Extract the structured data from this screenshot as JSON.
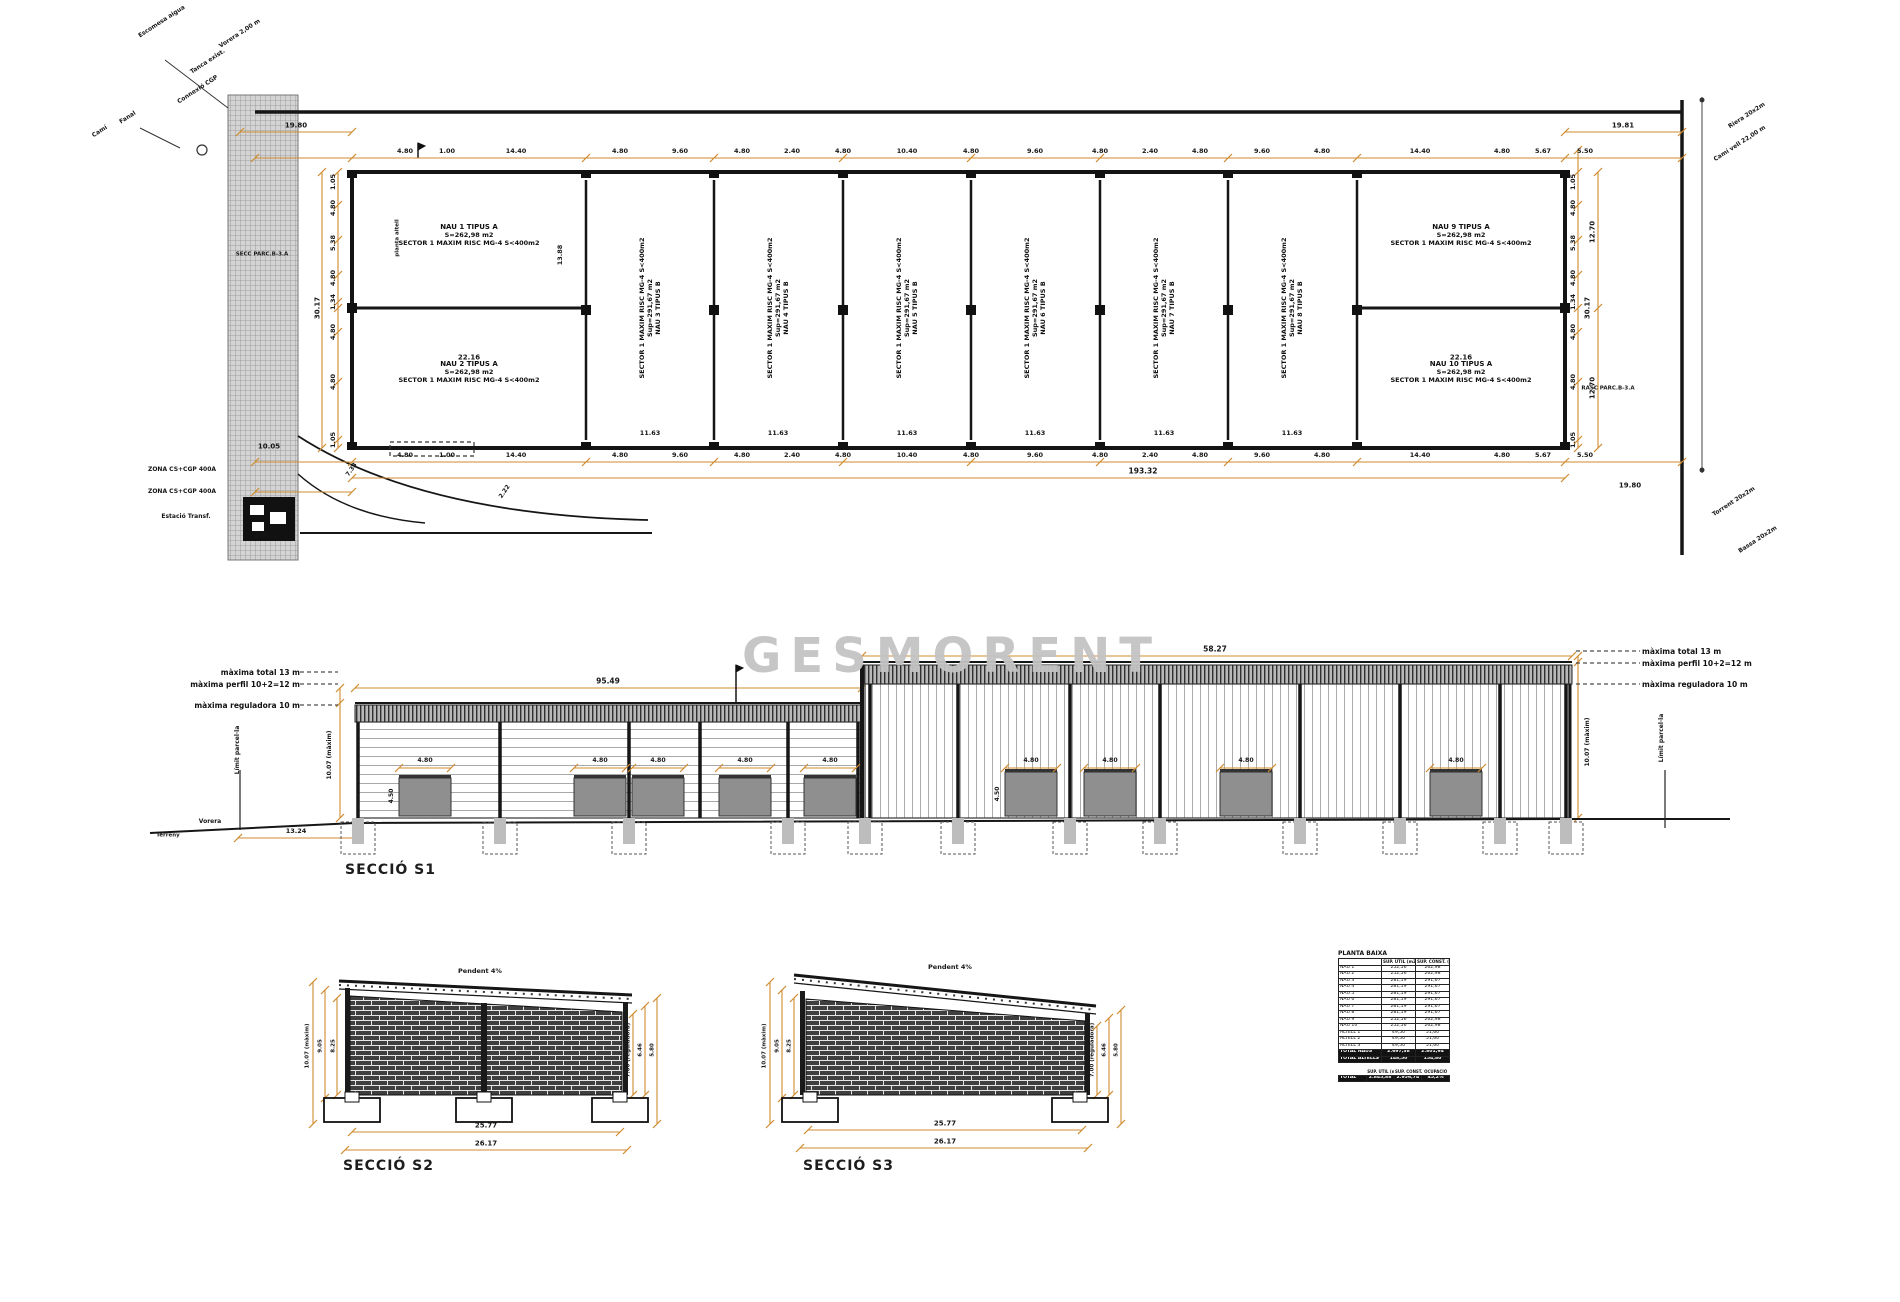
{
  "watermark": "GESMORENT",
  "colors": {
    "dim": "#cf8b2f",
    "wall": "#161616",
    "watermark": "#c3c3c3",
    "door": "#8f8f8f"
  },
  "plan": {
    "dim_row": [
      [
        "4.80",
        405
      ],
      [
        "1.00",
        447
      ],
      [
        "14.40",
        516
      ],
      [
        "4.80",
        620
      ],
      [
        "9.60",
        680
      ],
      [
        "4.80",
        742
      ],
      [
        "2.40",
        792
      ],
      [
        "4.80",
        843
      ],
      [
        "10.40",
        907
      ],
      [
        "4.80",
        971
      ],
      [
        "9.60",
        1035
      ],
      [
        "4.80",
        1100
      ],
      [
        "2.40",
        1150
      ],
      [
        "4.80",
        1200
      ],
      [
        "9.60",
        1262
      ],
      [
        "4.80",
        1322
      ],
      [
        "14.40",
        1420
      ],
      [
        "4.80",
        1502
      ],
      [
        "5.67",
        1543
      ],
      [
        "5.50",
        1585
      ]
    ],
    "left_chain": [
      [
        "1.05",
        182
      ],
      [
        "4.80",
        208
      ],
      [
        "5.38",
        243
      ],
      [
        "4.80",
        278
      ],
      [
        "1.34",
        302
      ],
      [
        "4.80",
        332
      ],
      [
        "4.80",
        382
      ],
      [
        "1.05",
        440
      ]
    ],
    "bays": [
      {
        "l1": "SECTOR 1 MAXIM RISC MG-4 S<400m2",
        "l2": "Sup=291,67 m2",
        "l3": "NAU 3 TIPUS B",
        "x": 650
      },
      {
        "l1": "SECTOR 1 MAXIM RISC MG-4 S<400m2",
        "l2": "Sup=291,67 m2",
        "l3": "NAU 4 TIPUS B",
        "x": 778
      },
      {
        "l1": "SECTOR 1 MAXIM RISC MG-4 S<400m2",
        "l2": "Sup=291,67 m2",
        "l3": "NAU 5 TIPUS B",
        "x": 907
      },
      {
        "l1": "SECTOR 1 MAXIM RISC MG-4 S<400m2",
        "l2": "Sup=291,67 m2",
        "l3": "NAU 6 TIPUS B",
        "x": 1035
      },
      {
        "l1": "SECTOR 1 MAXIM RISC MG-4 S<400m2",
        "l2": "Sup=291,67 m2",
        "l3": "NAU 7 TIPUS B",
        "x": 1164
      },
      {
        "l1": "SECTOR 1 MAXIM RISC MG-4 S<400m2",
        "l2": "Sup=291,67 m2",
        "l3": "NAU 8 TIPUS B",
        "x": 1292
      }
    ],
    "units": [
      {
        "l1": "NAU 1 TIPUS A",
        "l2": "S=262,98 m2",
        "l3": "SECTOR 1 MAXIM RISC MG-4 S<400m2",
        "x": 469,
        "y": 235
      },
      {
        "l1": "NAU 2 TIPUS A",
        "l2": "S=262,98 m2",
        "l3": "SECTOR 1 MAXIM RISC MG-4 S<400m2",
        "x": 469,
        "y": 372
      },
      {
        "l1": "NAU 9 TIPUS A",
        "l2": "S=262,98 m2",
        "l3": "SECTOR 1 MAXIM RISC MG-4 S<400m2",
        "x": 1461,
        "y": 235
      },
      {
        "l1": "NAU 10 TIPUS A",
        "l2": "S=262,98 m2",
        "l3": "SECTOR 1 MAXIM RISC MG-4 S<400m2",
        "x": 1461,
        "y": 372
      }
    ]
  },
  "s1": {
    "label": "SECCIÓ S1",
    "ann": [
      "màxima total 13 m",
      "màxima perfil 10+2=12 m",
      "màxima reguladora 10 m"
    ],
    "door_dim": "4.80",
    "doors": [
      425,
      600,
      658,
      745,
      830,
      1031,
      1110,
      1246,
      1456
    ]
  },
  "s2": {
    "label": "SECCIÓ S2"
  },
  "s3": {
    "label": "SECCIÓ S3"
  },
  "table": {
    "title": "PLANTA BAIXA",
    "col_util": "SUP. ÚTIL (m2)",
    "col_const": "SUP. CONST. (m2)",
    "rows": [
      [
        "NAU 1",
        "252,56",
        "262,98"
      ],
      [
        "NAU 2",
        "252,56",
        "262,98"
      ],
      [
        "NAU 3",
        "281,19",
        "291,67"
      ],
      [
        "NAU 4",
        "281,19",
        "291,67"
      ],
      [
        "NAU 5",
        "281,19",
        "291,67"
      ],
      [
        "NAU 6",
        "281,19",
        "291,67"
      ],
      [
        "NAU 7",
        "281,19",
        "291,67"
      ],
      [
        "NAU 8",
        "281,19",
        "291,67"
      ],
      [
        "NAU 9",
        "252,56",
        "262,98"
      ],
      [
        "NAU 10",
        "252,56",
        "262,98"
      ],
      [
        "ALTELL 1",
        "49,50",
        "51,60"
      ],
      [
        "ALTELL 2",
        "49,50",
        "51,60"
      ],
      [
        "ALTELL 3",
        "49,50",
        "51,60"
      ]
    ],
    "totals": [
      [
        "TOTAL NAUS",
        "2.697,38",
        "2.801,94"
      ],
      [
        "TOTAL ALTELLS",
        "148,50",
        "154,80"
      ]
    ],
    "summary_label": "TOTAL",
    "summary_headers": [
      "SUP. ÚTIL (m2)",
      "SUP. CONST. (m2)",
      "OCUPACIÓ"
    ],
    "summary": [
      "2.845,88",
      "2.956,74",
      "45,2%"
    ]
  },
  "labels": [
    [
      "19.80",
      296,
      126,
      0,
      7
    ],
    [
      "19.81",
      1623,
      126,
      0,
      7
    ],
    [
      "10.05",
      269,
      447,
      0,
      7
    ],
    [
      "193.32",
      1143,
      471,
      0,
      7.5
    ],
    [
      "19.80",
      1630,
      486,
      0,
      7
    ],
    [
      "7.33",
      352,
      470,
      -55,
      6
    ],
    [
      "2.22",
      505,
      492,
      -55,
      6
    ],
    [
      "4.00",
      262,
      537,
      0,
      6
    ],
    [
      "30.17",
      318,
      308,
      -90,
      7
    ],
    [
      "30.17",
      1588,
      308,
      -90,
      7
    ],
    [
      "12.70",
      1593,
      232,
      -90,
      7
    ],
    [
      "12.70",
      1593,
      388,
      -90,
      7
    ],
    [
      "22.16",
      469,
      358,
      0,
      7
    ],
    [
      "22.16",
      1461,
      358,
      0,
      7
    ],
    [
      "11.63",
      650,
      433,
      0,
      6.5
    ],
    [
      "11.63",
      778,
      433,
      0,
      6.5
    ],
    [
      "11.63",
      907,
      433,
      0,
      6.5
    ],
    [
      "11.63",
      1035,
      433,
      0,
      6.5
    ],
    [
      "11.63",
      1164,
      433,
      0,
      6.5
    ],
    [
      "11.63",
      1292,
      433,
      0,
      6.5
    ],
    [
      "13.88",
      560,
      255,
      -90,
      6.5
    ],
    [
      "planta altell",
      398,
      238,
      -90,
      5.5
    ],
    [
      "SECC PARC.B-3.A",
      262,
      255,
      0,
      5.5
    ],
    [
      "RASC PARC.B-3.A",
      1608,
      389,
      0,
      5.5
    ],
    [
      "ZONA CS+CGP 400A",
      182,
      470,
      0,
      6
    ],
    [
      "ZONA CS+CGP 400A",
      182,
      492,
      0,
      6
    ],
    [
      "Estació Transf.",
      186,
      517,
      0,
      6
    ],
    [
      "Escomesa aigua",
      162,
      22,
      -33,
      6
    ],
    [
      "Vorera 2,00 m",
      240,
      34,
      -33,
      6
    ],
    [
      "Tanca exist.",
      208,
      62,
      -33,
      6
    ],
    [
      "Connexió CGP",
      198,
      90,
      -33,
      6
    ],
    [
      "Fanal",
      128,
      118,
      -33,
      6
    ],
    [
      "Camí",
      100,
      132,
      -33,
      6
    ],
    [
      "Riera 20x2m",
      1747,
      116,
      -33,
      6
    ],
    [
      "Camí vell 22,00 m",
      1740,
      144,
      -33,
      6
    ],
    [
      "Torrent 20x2m",
      1734,
      502,
      -33,
      6
    ],
    [
      "Bassa 20x2m",
      1758,
      540,
      -33,
      6
    ],
    [
      "95.49",
      608,
      681,
      0,
      7.5
    ],
    [
      "58.27",
      1215,
      649,
      0,
      7.5
    ],
    [
      "4.50",
      392,
      796,
      -90,
      6
    ],
    [
      "4.50",
      998,
      794,
      -90,
      6
    ],
    [
      "10.07 (màxim)",
      330,
      755,
      -90,
      6
    ],
    [
      "10.07 (màxim)",
      1588,
      742,
      -90,
      6
    ],
    [
      "13.24",
      296,
      831,
      0,
      6.5
    ],
    [
      "Vorera",
      210,
      822,
      0,
      6
    ],
    [
      "Terreny",
      168,
      836,
      0,
      5.5
    ],
    [
      "Límit parcel·la",
      238,
      750,
      -90,
      6
    ],
    [
      "Límit parcel·la",
      1662,
      738,
      -90,
      6
    ],
    [
      "Pendent 4%",
      480,
      971,
      0,
      6.5
    ],
    [
      "Pendent 4%",
      950,
      967,
      0,
      6.5
    ],
    [
      "25.77",
      486,
      1126,
      0,
      7
    ],
    [
      "26.17",
      486,
      1144,
      0,
      7
    ],
    [
      "25.77",
      945,
      1124,
      0,
      7
    ],
    [
      "26.17",
      945,
      1142,
      0,
      7
    ],
    [
      "10.07 (màxim)",
      308,
      1046,
      -90,
      5.5
    ],
    [
      "9.05",
      321,
      1046,
      -90,
      5.5
    ],
    [
      "8.25",
      334,
      1046,
      -90,
      5.5
    ],
    [
      "7.00 (reguladora)",
      629,
      1050,
      -90,
      5.5
    ],
    [
      "6.46",
      641,
      1050,
      -90,
      5.5
    ],
    [
      "5.80",
      653,
      1050,
      -90,
      5.5
    ],
    [
      "10.07 (màxim)",
      765,
      1046,
      -90,
      5.5
    ],
    [
      "9.05",
      778,
      1046,
      -90,
      5.5
    ],
    [
      "8.25",
      790,
      1046,
      -90,
      5.5
    ],
    [
      "7.00 (reguladora)",
      1093,
      1050,
      -90,
      5.5
    ],
    [
      "6.46",
      1105,
      1050,
      -90,
      5.5
    ],
    [
      "5.80",
      1117,
      1050,
      -90,
      5.5
    ]
  ],
  "geometry": {
    "plan_outer": [
      352,
      172,
      1213,
      276
    ],
    "dividers": [
      586,
      714,
      843,
      971,
      1100,
      1228,
      1357
    ],
    "split_y": 308,
    "dimh": [
      [
        158,
        255,
        1682,
        [
          255,
          352,
          586,
          714,
          843,
          971,
          1100,
          1228,
          1357,
          1565,
          1682
        ]
      ],
      [
        132,
        240,
        352,
        [
          240,
          352
        ]
      ],
      [
        132,
        1565,
        1682,
        [
          1565,
          1682
        ]
      ],
      [
        462,
        255,
        1682,
        [
          255,
          352,
          586,
          714,
          843,
          971,
          1100,
          1228,
          1357,
          1565,
          1682
        ]
      ],
      [
        478,
        352,
        1565,
        [
          352,
          1565
        ]
      ],
      [
        492,
        255,
        352,
        [
          255,
          352
        ]
      ],
      [
        688,
        355,
        862,
        [
          355,
          862
        ]
      ],
      [
        656,
        862,
        1572,
        [
          862,
          1572
        ]
      ],
      [
        838,
        238,
        358,
        [
          238,
          358
        ]
      ],
      [
        1132,
        352,
        620,
        [
          352,
          620
        ]
      ],
      [
        1150,
        345,
        627,
        [
          345,
          627
        ]
      ],
      [
        1130,
        808,
        1082,
        [
          808,
          1082
        ]
      ],
      [
        1148,
        800,
        1088,
        [
          800,
          1088
        ]
      ]
    ],
    "dimv": [
      [
        338,
        172,
        448,
        [
          172,
          205,
          240,
          275,
          302,
          308,
          332,
          382,
          440,
          448
        ]
      ],
      [
        322,
        172,
        448,
        [
          172,
          448
        ]
      ],
      [
        1578,
        150,
        448,
        [
          150,
          172,
          205,
          240,
          275,
          308,
          332,
          382,
          440,
          448
        ]
      ],
      [
        1598,
        172,
        448,
        [
          172,
          308,
          448
        ]
      ],
      [
        340,
        688,
        818,
        [
          688,
          703,
          818
        ]
      ],
      [
        1578,
        656,
        818,
        [
          656,
          662,
          818
        ]
      ],
      [
        313,
        982,
        1124,
        [
          982,
          1124
        ]
      ],
      [
        325,
        990,
        1098,
        [
          990,
          1098
        ]
      ],
      [
        337,
        998,
        1095,
        [
          998,
          1095
        ]
      ],
      [
        633,
        1014,
        1095,
        [
          1014,
          1095
        ]
      ],
      [
        645,
        1006,
        1095,
        [
          1006,
          1095
        ]
      ],
      [
        657,
        998,
        1124,
        [
          998,
          1124
        ]
      ],
      [
        770,
        982,
        1124,
        [
          982,
          1124
        ]
      ],
      [
        782,
        990,
        1098,
        [
          990,
          1098
        ]
      ],
      [
        794,
        998,
        1095,
        [
          998,
          1095
        ]
      ],
      [
        1097,
        1026,
        1095,
        [
          1026,
          1095
        ]
      ],
      [
        1109,
        1018,
        1095,
        [
          1018,
          1095
        ]
      ],
      [
        1121,
        1010,
        1124,
        [
          1010,
          1124
        ]
      ]
    ],
    "leaders": [
      [
        300,
        672,
        338,
        672
      ],
      [
        300,
        684,
        338,
        684
      ],
      [
        300,
        705,
        338,
        705
      ],
      [
        1576,
        651,
        1640,
        651
      ],
      [
        1576,
        663,
        1640,
        663
      ],
      [
        1576,
        684,
        1640,
        684
      ]
    ],
    "limit_lines": [
      [
        240,
        770,
        240,
        830
      ],
      [
        1665,
        770,
        1665,
        828
      ]
    ],
    "posts_left": [
      358,
      500,
      629,
      700,
      788,
      858
    ],
    "posts_right": [
      870,
      958,
      1070,
      1160,
      1300,
      1400,
      1500,
      1566
    ],
    "foundations": [
      358,
      500,
      629,
      788,
      865,
      958,
      1070,
      1160,
      1300,
      1400,
      1500,
      1566
    ],
    "footings_s2": [
      352,
      484,
      620
    ],
    "footings_s3": [
      810,
      1080
    ]
  }
}
